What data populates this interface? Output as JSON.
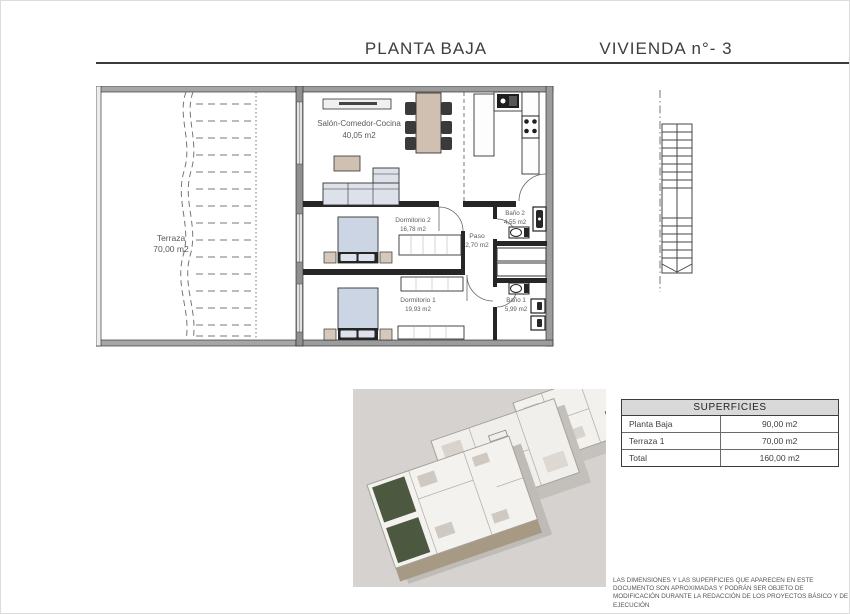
{
  "header": {
    "title_left": "PLANTA BAJA",
    "title_right": "VIVIENDA n°- 3"
  },
  "floor_plan": {
    "rooms": {
      "terraza": {
        "name": "Terraza",
        "area": "70,00 m2"
      },
      "salon": {
        "name": "Salón-Comedor-Cocina",
        "area": "40,05 m2"
      },
      "dormitorio2": {
        "name": "Dormitorio 2",
        "area": "16,78 m2"
      },
      "paso": {
        "name": "Paso",
        "area": "2,70 m2"
      },
      "bano2": {
        "name": "Baño 2",
        "area": "4,55 m2"
      },
      "dormitorio1": {
        "name": "Dormitorio 1",
        "area": "19,93 m2"
      },
      "bano1": {
        "name": "Baño 1",
        "area": "5,99 m2"
      }
    }
  },
  "superficies_table": {
    "header": "SUPERFICIES",
    "rows": [
      {
        "label": "Planta Baja",
        "value": "90,00 m2"
      },
      {
        "label": "Terraza 1",
        "value": "70,00 m2"
      },
      {
        "label": "Total",
        "value": "160,00 m2"
      }
    ]
  },
  "disclaimer": "LAS DIMENSIONES Y LAS SUPERFICIES QUE APARECEN EN ESTE DOCUMENTO SON APROXIMADAS Y PODRÁN SER OBJETO DE MODIFICACIÓN DURANTE LA REDACCIÓN DE LOS PROYECTOS BÁSICO Y DE EJECUCIÓN",
  "colors": {
    "wall_dark": "#262626",
    "wall_gray": "#9c9c9c",
    "furniture_wood": "#d2c4b6",
    "furniture_soft": "#ccd5e4",
    "table_header_bg": "#d9d9d9",
    "render_bg": "#d5d2cf",
    "accent_green": "#4c5840"
  }
}
